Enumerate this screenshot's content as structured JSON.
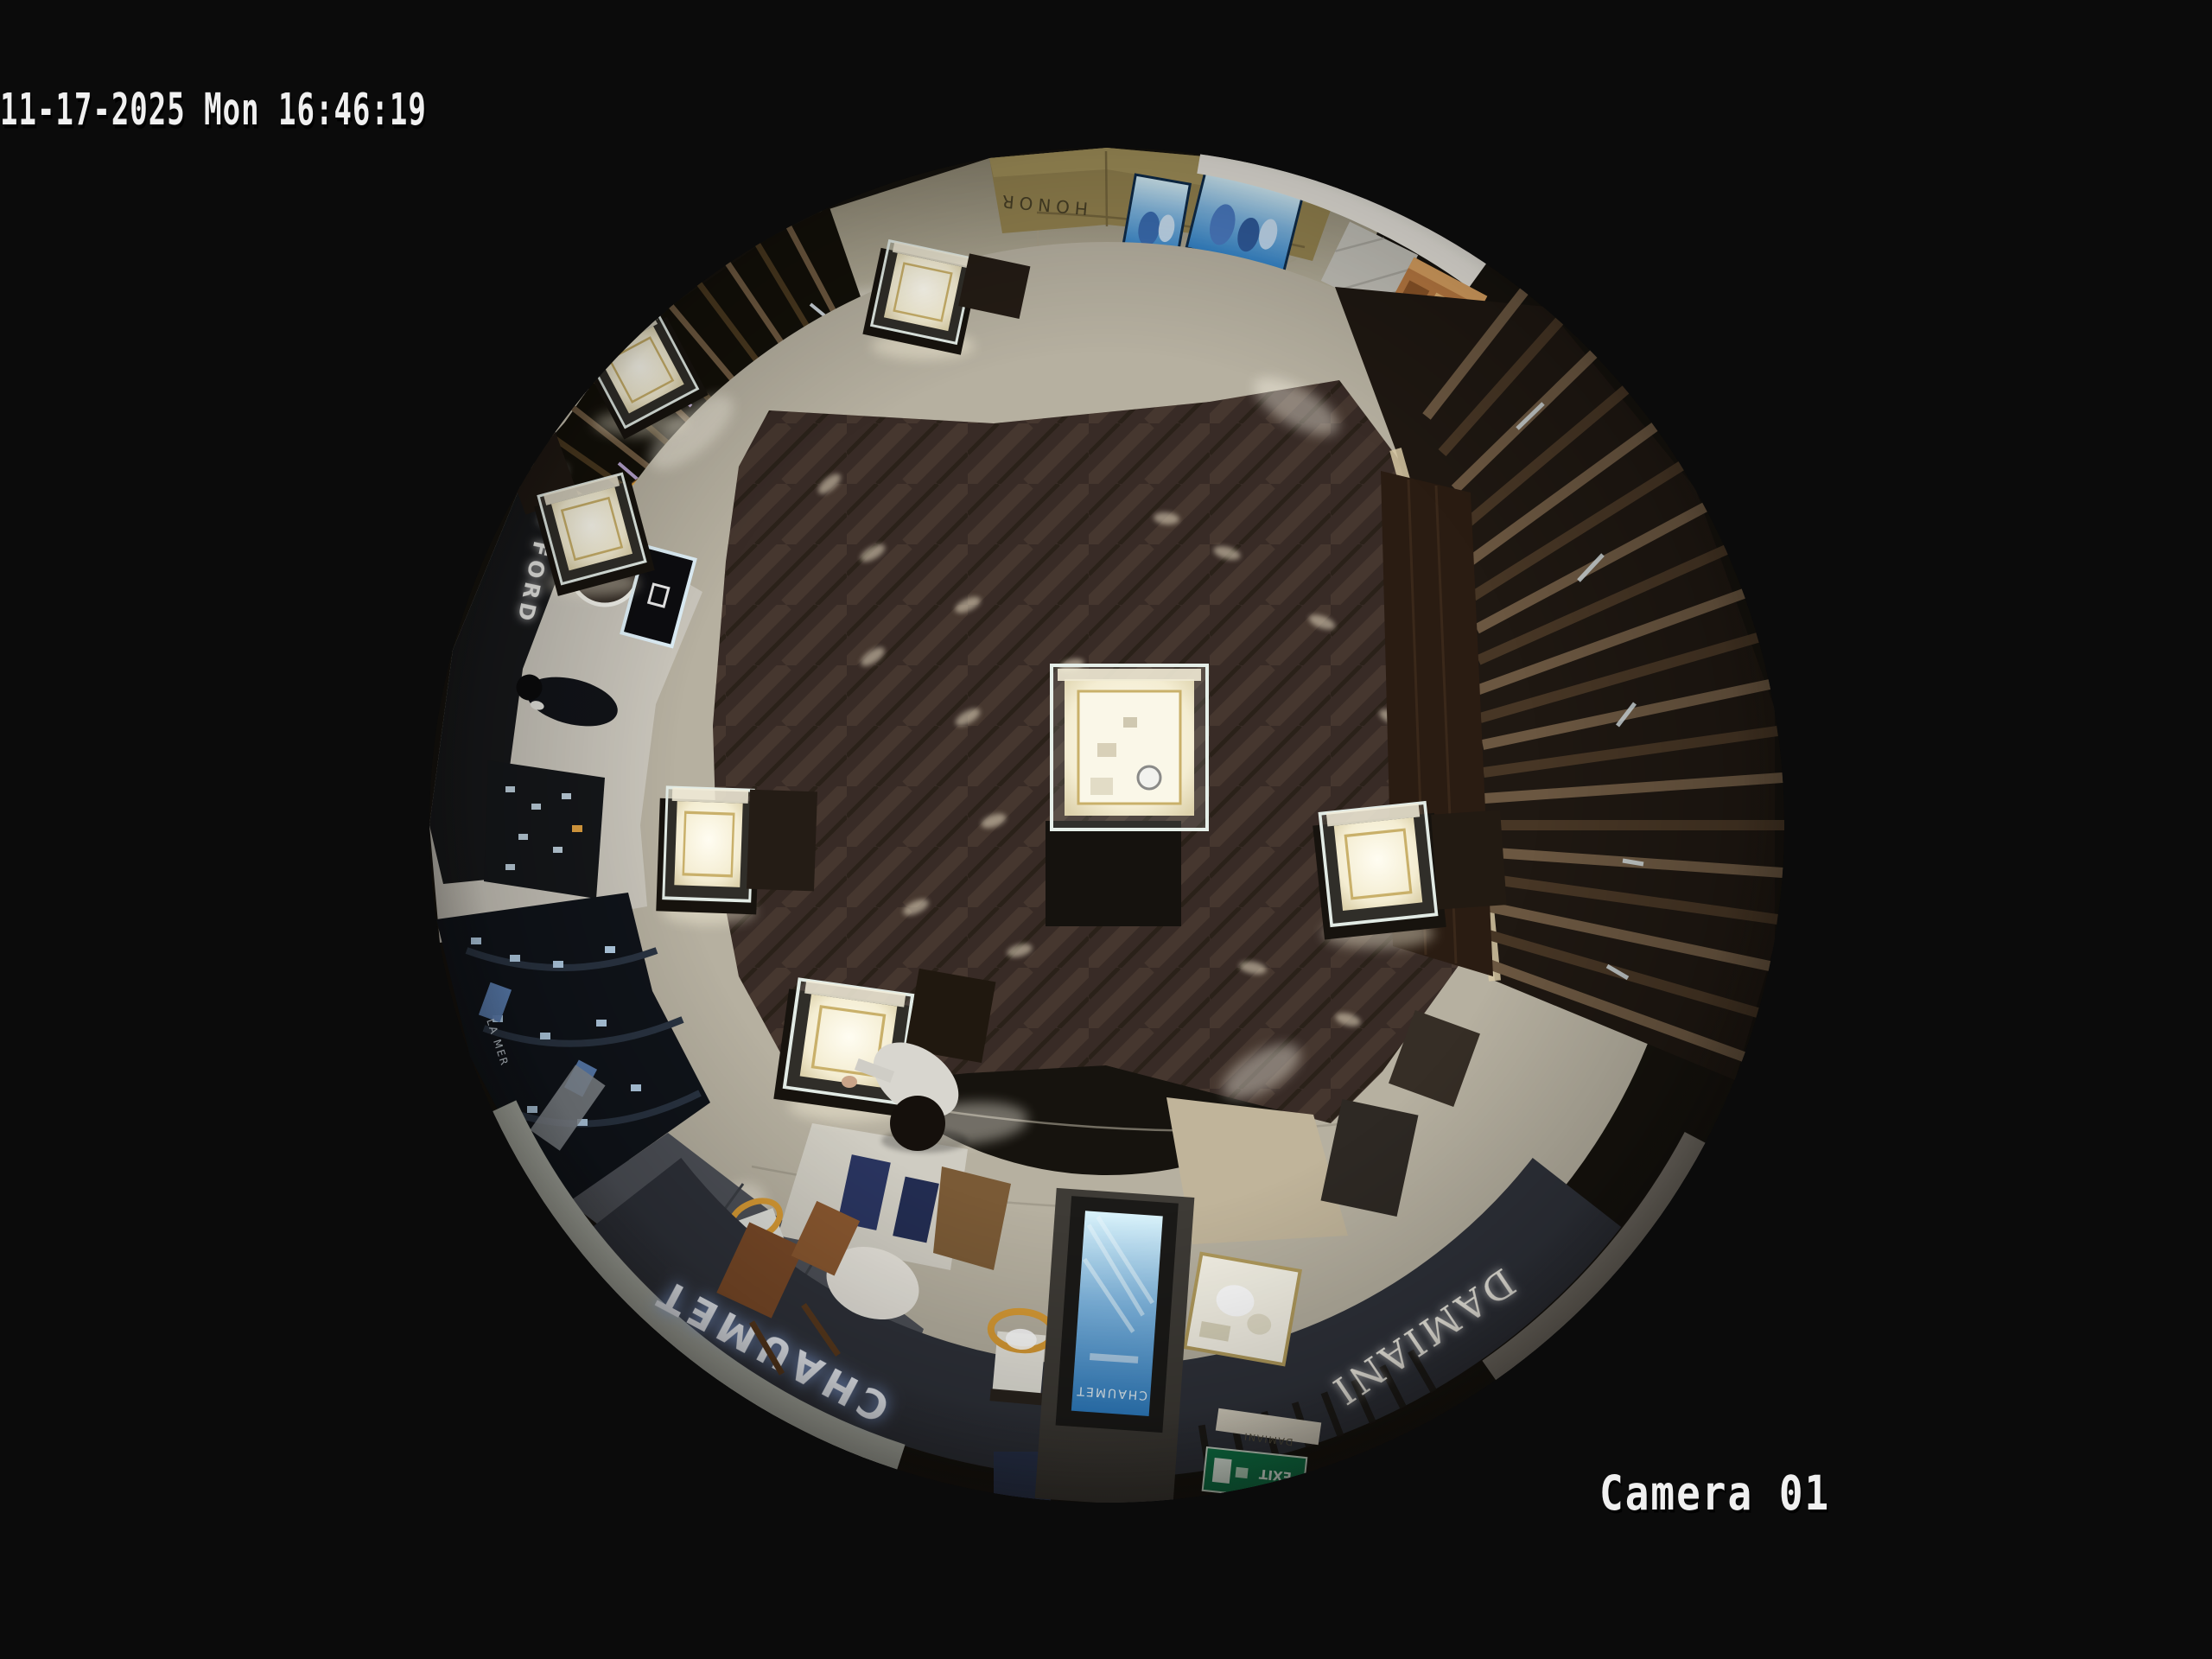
{
  "overlay": {
    "timestamp": "11-17-2025 Mon 16:46:19",
    "camera_label": "Camera 01"
  },
  "scene": {
    "signs": {
      "chaumet": "CHAUMET",
      "chaumet_screen": "CHAUMET",
      "chaumet_small": "CHAUMET",
      "damiani": "DAMIANI",
      "damiani_small": "DAMIANI",
      "tom_ford": "TOM FORD",
      "la_mer": "LA MER",
      "mall_store": "HONOR",
      "exit": "EXIT"
    },
    "colors": {
      "background": "#000000",
      "osd_text": "#f0f0f0",
      "exit_green": "#0e7a4a",
      "screen_blue": "#2f7fc4",
      "led_amber": "#e8a83e",
      "wood_floor": "#4a3a2e",
      "stone_floor": "#c9c4b4"
    }
  }
}
